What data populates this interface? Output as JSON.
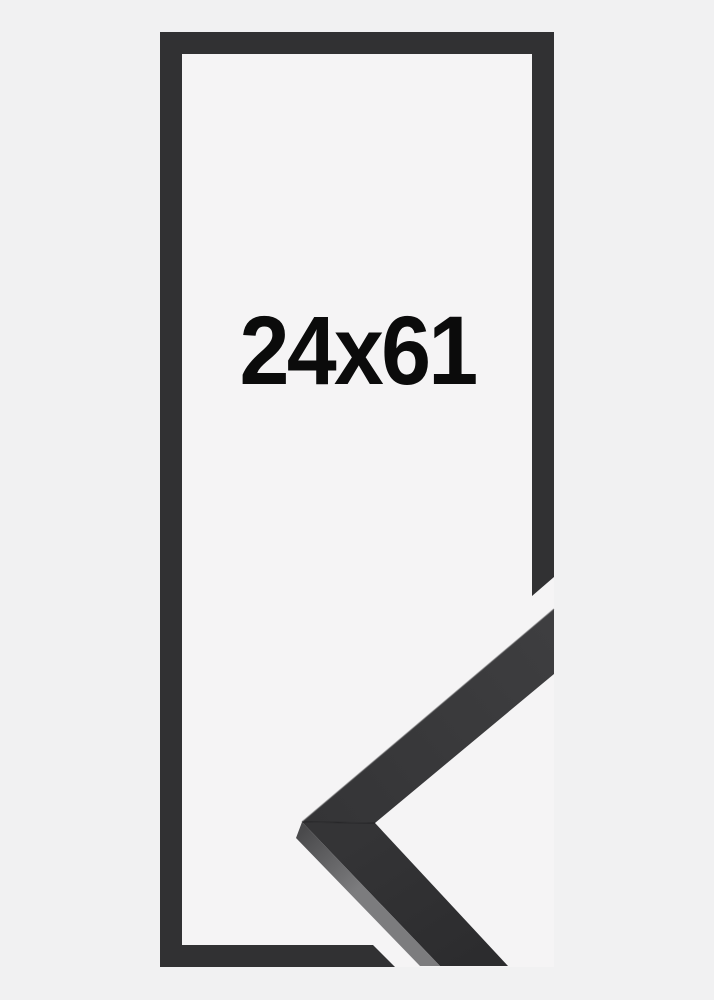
{
  "image": {
    "size_label": "24x61",
    "description": "Black picture frame outline with corner profile sample"
  },
  "colors": {
    "background": "#f1f1f2",
    "opening": "#f5f4f5",
    "frame": "#313133",
    "sample_face_light": "#3e3e40",
    "sample_face": "#343436",
    "sample_face_dark": "#2c2c2e",
    "sample_edge_dark": "#4a4a4c",
    "sample_edge_light": "#7c7c7e",
    "sample_seam": "#1e1e20",
    "sample_highlight": "#5c5c5e",
    "text": "#0b0b0b"
  }
}
